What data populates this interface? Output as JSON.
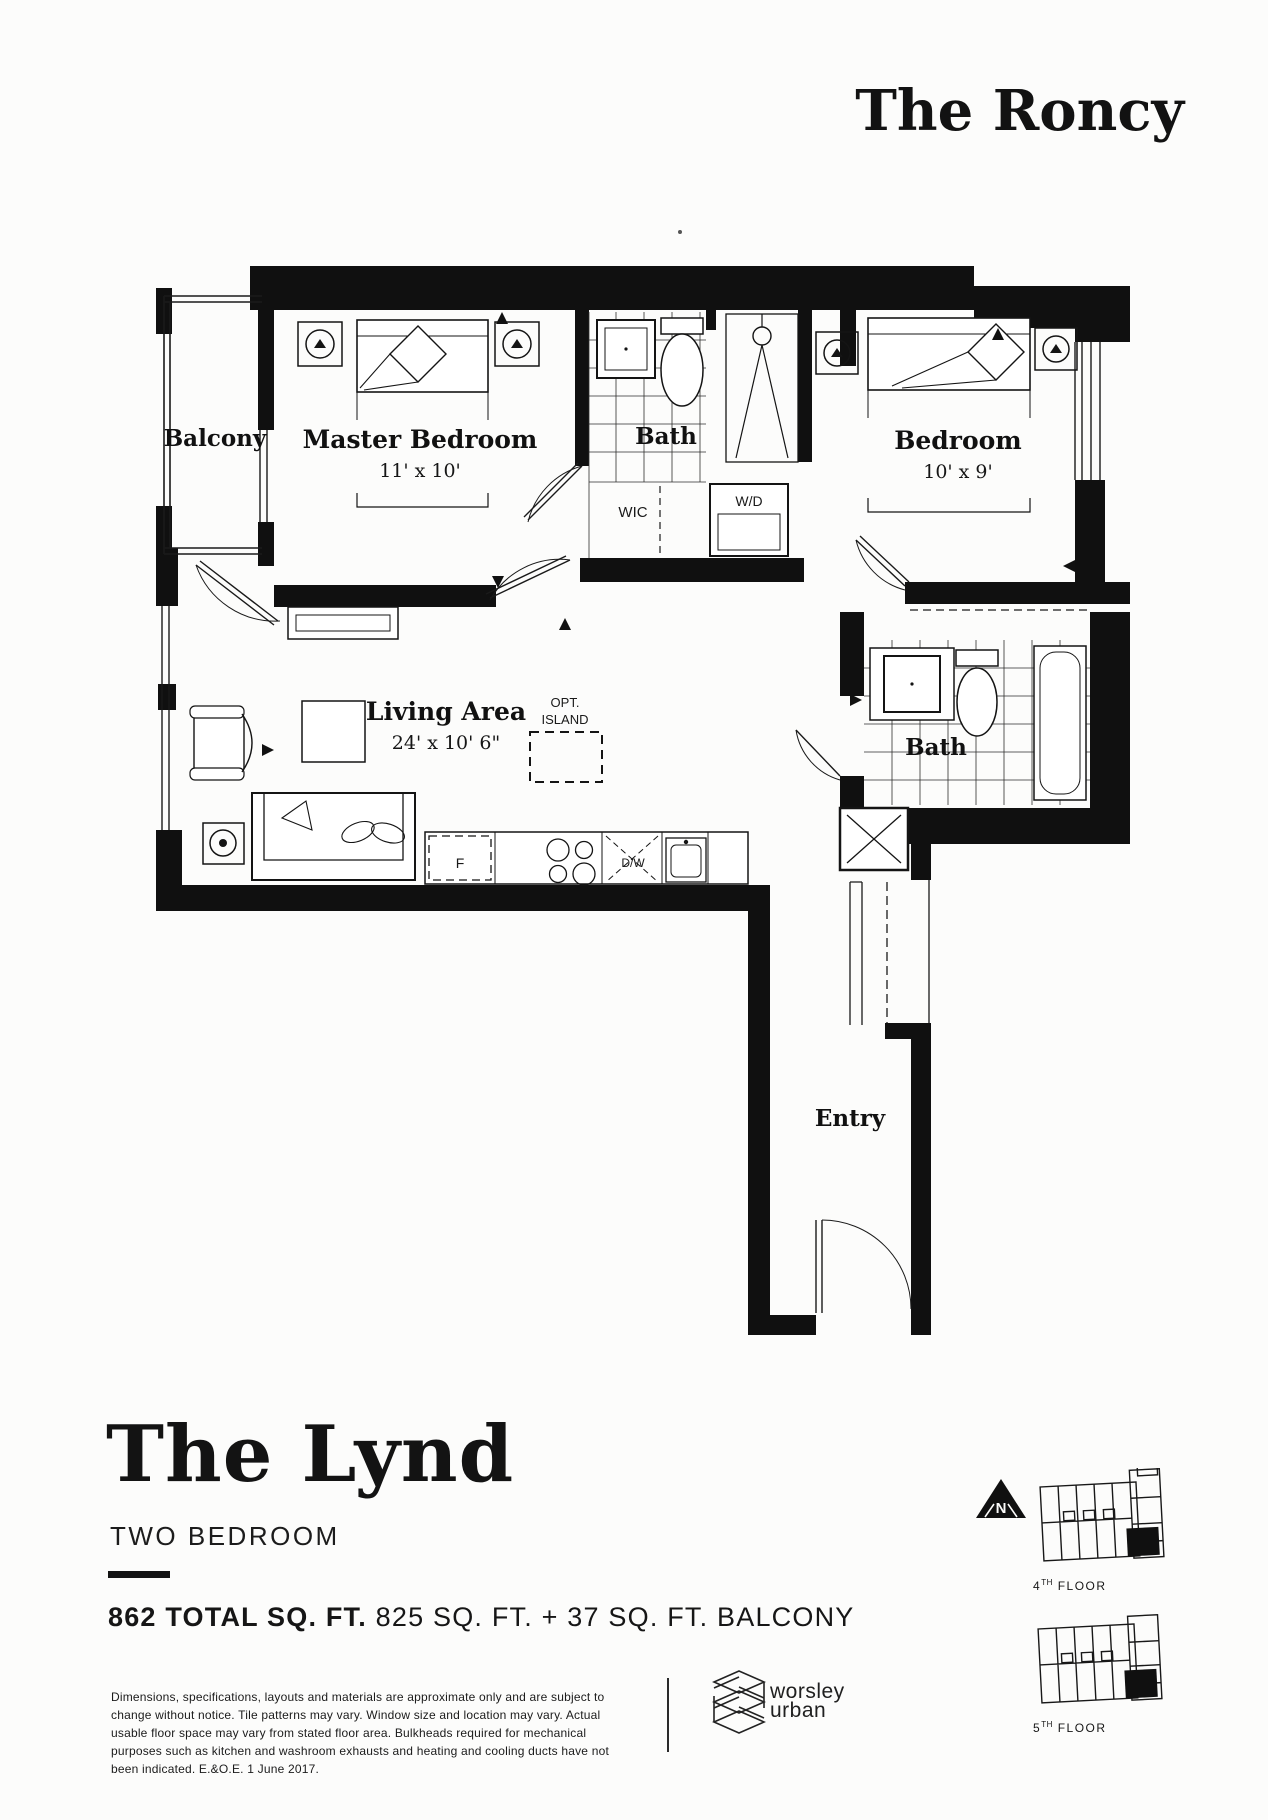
{
  "header": {
    "brand": "The Roncy"
  },
  "plan": {
    "balcony": "Balcony",
    "master_bedroom": "Master Bedroom",
    "master_dims": "11' x 10'",
    "bath_upper": "Bath",
    "wic": "WIC",
    "washer_dryer": "W/D",
    "bedroom": "Bedroom",
    "bedroom_dims": "10' x 9'",
    "living": "Living Area",
    "living_dims": "24' x 10' 6\"",
    "island_opt": "OPT.",
    "island": "ISLAND",
    "bath_lower": "Bath",
    "entry": "Entry",
    "fridge": "F",
    "dishwasher": "D/W"
  },
  "unit": {
    "name": "The Lynd",
    "type": "TWO BEDROOM",
    "area_total": "862 TOTAL SQ. FT.",
    "area_detail": " 825 SQ. FT. + 37 SQ. FT. BALCONY"
  },
  "disclaimer": "Dimensions, specifications, layouts and materials are approximate only and are subject to change without notice. Tile patterns may vary. Window size and location may vary. Actual usable floor space may vary from stated floor area. Bulkheads required for mechanical purposes such as kitchen and washroom exhausts and heating and cooling ducts have not been indicated. E.&O.E. 1 June 2017.",
  "developer": {
    "line1": "worsley",
    "line2": "urban"
  },
  "compass": {
    "north": "N"
  },
  "keyplans": [
    {
      "num": "4",
      "suffix": "TH",
      "rest": " FLOOR"
    },
    {
      "num": "5",
      "suffix": "TH",
      "rest": " FLOOR"
    }
  ]
}
